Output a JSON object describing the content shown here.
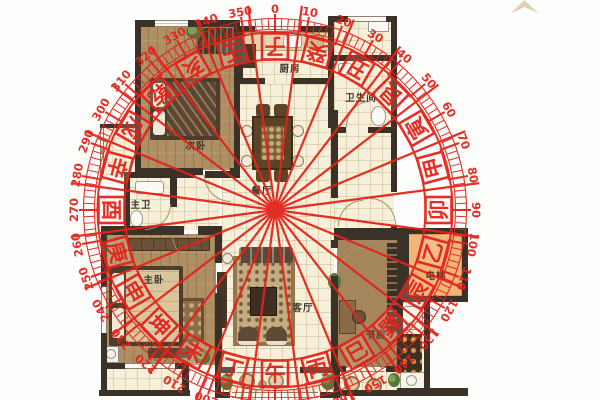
{
  "rooms": [
    {
      "id": "ciwo",
      "label": "次卧",
      "x": 196,
      "y": 145
    },
    {
      "id": "chufang",
      "label": "厨房",
      "x": 290,
      "y": 68
    },
    {
      "id": "weishengjian",
      "label": "卫生间",
      "x": 361,
      "y": 97
    },
    {
      "id": "canting",
      "label": "餐厅",
      "x": 262,
      "y": 190
    },
    {
      "id": "zhuwei",
      "label": "主卫",
      "x": 141,
      "y": 204
    },
    {
      "id": "zhuwo",
      "label": "主卧",
      "x": 154,
      "y": 279
    },
    {
      "id": "keting",
      "label": "客厅",
      "x": 303,
      "y": 307
    },
    {
      "id": "shufang",
      "label": "书房",
      "x": 376,
      "y": 334
    },
    {
      "id": "dianti",
      "label": "电梯",
      "x": 436,
      "y": 275
    }
  ],
  "compass": {
    "center": {
      "x": 275,
      "y": 210
    },
    "color": "#e3231a",
    "degrees": [
      0,
      10,
      20,
      30,
      40,
      50,
      60,
      70,
      80,
      90,
      100,
      110,
      120,
      130,
      140,
      150,
      160,
      170,
      180,
      190,
      200,
      210,
      220,
      230,
      240,
      250,
      260,
      270,
      280,
      290,
      300,
      310,
      320,
      330,
      340,
      350
    ],
    "mountains": [
      {
        "name": "子",
        "angle": 0
      },
      {
        "name": "癸",
        "angle": 15
      },
      {
        "name": "丑",
        "angle": 30
      },
      {
        "name": "艮",
        "angle": 45
      },
      {
        "name": "寅",
        "angle": 60
      },
      {
        "name": "甲",
        "angle": 75
      },
      {
        "name": "卯",
        "angle": 90
      },
      {
        "name": "乙",
        "angle": 105
      },
      {
        "name": "辰",
        "angle": 120
      },
      {
        "name": "巽",
        "angle": 135
      },
      {
        "name": "巳",
        "angle": 150
      },
      {
        "name": "丙",
        "angle": 165
      },
      {
        "name": "午",
        "angle": 180
      },
      {
        "name": "丁",
        "angle": 195
      },
      {
        "name": "未",
        "angle": 210
      },
      {
        "name": "坤",
        "angle": 225
      },
      {
        "name": "申",
        "angle": 240
      },
      {
        "name": "庚",
        "angle": 255
      },
      {
        "name": "酉",
        "angle": 270
      },
      {
        "name": "辛",
        "angle": 285
      },
      {
        "name": "戌",
        "angle": 300
      },
      {
        "name": "乾",
        "angle": 315
      },
      {
        "name": "亥",
        "angle": 330
      },
      {
        "name": "壬",
        "angle": 345
      }
    ],
    "radii": {
      "inner_circle": 150.5,
      "outer_circle": 177.5,
      "tick_inner": 181,
      "tick_outer": 191,
      "box_radius": 163.5,
      "label_radius": 201,
      "line_length": 206
    }
  },
  "decorations": {
    "north_star_color": "#d8c79e"
  },
  "colors": {
    "wall": "#3a3128",
    "tile": "#f6efd9",
    "wood": "#b08e64",
    "elevator": "#f2b477",
    "overlay_red": "#e3231a"
  }
}
